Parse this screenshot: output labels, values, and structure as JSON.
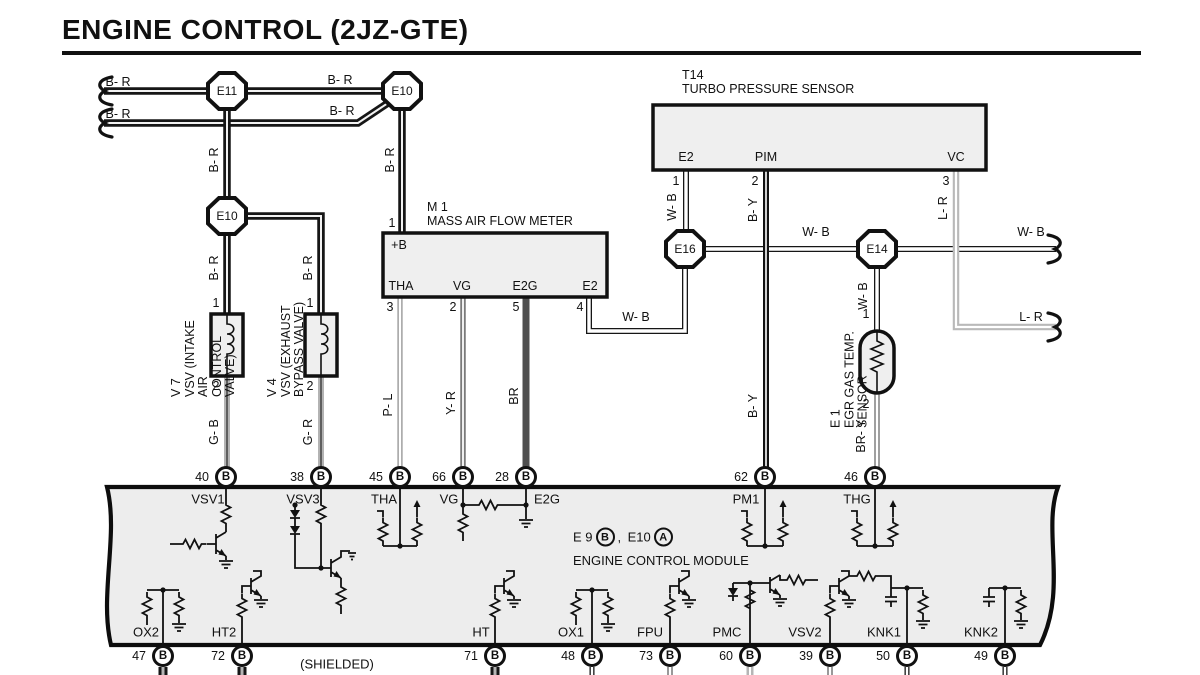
{
  "title": "ENGINE CONTROL (2JZ-GTE)",
  "colors": {
    "ecm_fill": "#ededed",
    "box_fill": "#efefef",
    "line": "#111111"
  },
  "connectors": [
    {
      "label": "E11",
      "x": 227,
      "y": 91
    },
    {
      "label": "E10",
      "x": 402,
      "y": 91
    },
    {
      "label": "E10",
      "x": 227,
      "y": 216
    },
    {
      "label": "E16",
      "x": 685,
      "y": 249
    },
    {
      "label": "E14",
      "x": 877,
      "y": 249
    }
  ],
  "boxes": {
    "turbo": {
      "ref": "T14",
      "name": "TURBO PRESSURE SENSOR",
      "terminals": [
        {
          "t": "E2",
          "x": 686,
          "y": 157
        },
        {
          "t": "PIM",
          "x": 766,
          "y": 157
        },
        {
          "t": "VC",
          "x": 956,
          "y": 157
        }
      ]
    },
    "maf": {
      "ref": "M 1",
      "name": "MASS AIR FLOW METER",
      "terminals": [
        {
          "t": "+B",
          "x": 399,
          "y": 245
        },
        {
          "t": "THA",
          "x": 401,
          "y": 286
        },
        {
          "t": "VG",
          "x": 462,
          "y": 286
        },
        {
          "t": "E2G",
          "x": 525,
          "y": 286
        },
        {
          "t": "E2",
          "x": 590,
          "y": 286
        }
      ]
    }
  },
  "components": [
    {
      "lines": [
        "V 7",
        "VSV (INTAKE AIR",
        "CONTROL VALVE)"
      ],
      "x": 190,
      "y": 347,
      "w": 100,
      "h": 40
    },
    {
      "lines": [
        "V 4",
        "VSV (EXHAUST",
        "BYPASS VALVE)"
      ],
      "x": 286,
      "y": 347,
      "w": 100,
      "h": 40
    },
    {
      "lines": [
        "E 1",
        "EGR GAS TEMP. SENSOR"
      ],
      "x": 843,
      "y": 363,
      "w": 130,
      "h": 27
    }
  ],
  "wire_labels": [
    {
      "t": "B- R",
      "x": 118,
      "y": 82
    },
    {
      "t": "B- R",
      "x": 118,
      "y": 114
    },
    {
      "t": "B- R",
      "x": 340,
      "y": 80
    },
    {
      "t": "B- R",
      "x": 342,
      "y": 111
    },
    {
      "t": "B- R",
      "x": 214,
      "y": 160,
      "r": 1
    },
    {
      "t": "B- R",
      "x": 390,
      "y": 160,
      "r": 1
    },
    {
      "t": "B- R",
      "x": 214,
      "y": 268,
      "r": 1
    },
    {
      "t": "B- R",
      "x": 308,
      "y": 268,
      "r": 1
    },
    {
      "t": "G- B",
      "x": 214,
      "y": 432,
      "r": 1
    },
    {
      "t": "G- R",
      "x": 308,
      "y": 432,
      "r": 1
    },
    {
      "t": "P- L",
      "x": 388,
      "y": 405,
      "r": 1
    },
    {
      "t": "Y- R",
      "x": 451,
      "y": 403,
      "r": 1
    },
    {
      "t": "BR",
      "x": 514,
      "y": 396,
      "r": 1
    },
    {
      "t": "W- B",
      "x": 636,
      "y": 317
    },
    {
      "t": "W- B",
      "x": 672,
      "y": 207,
      "r": 1
    },
    {
      "t": "B- Y",
      "x": 753,
      "y": 210,
      "r": 1
    },
    {
      "t": "B- Y",
      "x": 753,
      "y": 406,
      "r": 1
    },
    {
      "t": "L- R",
      "x": 943,
      "y": 208,
      "r": 1
    },
    {
      "t": "W- B",
      "x": 816,
      "y": 232
    },
    {
      "t": "W- B",
      "x": 1031,
      "y": 232
    },
    {
      "t": "L- R",
      "x": 1031,
      "y": 317
    },
    {
      "t": "W- B",
      "x": 863,
      "y": 296,
      "r": 1
    },
    {
      "t": "BR- Y",
      "x": 861,
      "y": 436,
      "r": 1
    }
  ],
  "pin_numbers": [
    {
      "t": "1",
      "x": 392,
      "y": 223
    },
    {
      "t": "3",
      "x": 390,
      "y": 307
    },
    {
      "t": "2",
      "x": 453,
      "y": 307
    },
    {
      "t": "5",
      "x": 516,
      "y": 307
    },
    {
      "t": "4",
      "x": 580,
      "y": 307
    },
    {
      "t": "1",
      "x": 676,
      "y": 181
    },
    {
      "t": "2",
      "x": 755,
      "y": 181
    },
    {
      "t": "3",
      "x": 946,
      "y": 181
    },
    {
      "t": "1",
      "x": 216,
      "y": 303
    },
    {
      "t": "2",
      "x": 216,
      "y": 386
    },
    {
      "t": "1",
      "x": 310,
      "y": 303
    },
    {
      "t": "2",
      "x": 310,
      "y": 386
    },
    {
      "t": "1",
      "x": 866,
      "y": 314
    },
    {
      "t": "2",
      "x": 866,
      "y": 404
    }
  ],
  "ecm": {
    "top_terminals": [
      {
        "pin": "40",
        "conn": "B",
        "name": "VSV1",
        "x": 226,
        "nx": 208
      },
      {
        "pin": "38",
        "conn": "B",
        "name": "VSV3",
        "x": 321,
        "nx": 303
      },
      {
        "pin": "45",
        "conn": "B",
        "name": "THA",
        "x": 400,
        "nx": 384
      },
      {
        "pin": "66",
        "conn": "B",
        "name": "VG",
        "x": 463,
        "nx": 449
      },
      {
        "pin": "28",
        "conn": "B",
        "name": "E2G",
        "x": 526,
        "nx": 547
      },
      {
        "pin": "62",
        "conn": "B",
        "name": "PM1",
        "x": 765,
        "nx": 746
      },
      {
        "pin": "46",
        "conn": "B",
        "name": "THG",
        "x": 875,
        "nx": 857
      }
    ],
    "bottom_terminals": [
      {
        "pin": "47",
        "conn": "B",
        "name": "OX2",
        "x": 163,
        "nx": 146
      },
      {
        "pin": "72",
        "conn": "B",
        "name": "HT2",
        "x": 242,
        "nx": 224
      },
      {
        "pin": "71",
        "conn": "B",
        "name": "HT",
        "x": 495,
        "nx": 481
      },
      {
        "pin": "48",
        "conn": "B",
        "name": "OX1",
        "x": 592,
        "nx": 571
      },
      {
        "pin": "73",
        "conn": "B",
        "name": "FPU",
        "x": 670,
        "nx": 650
      },
      {
        "pin": "60",
        "conn": "B",
        "name": "PMC",
        "x": 750,
        "nx": 727
      },
      {
        "pin": "39",
        "conn": "B",
        "name": "VSV2",
        "x": 830,
        "nx": 805
      },
      {
        "pin": "50",
        "conn": "B",
        "name": "KNK1",
        "x": 907,
        "nx": 884
      },
      {
        "pin": "49",
        "conn": "B",
        "name": "KNK2",
        "x": 1005,
        "nx": 981
      }
    ],
    "note": {
      "x": 573,
      "y": 537,
      "refs": [
        {
          "label": "E 9",
          "letter": "B"
        },
        {
          "label": "E10",
          "letter": "A"
        }
      ],
      "line2": "ENGINE CONTROL MODULE"
    },
    "shielded": "(SHIELDED)"
  }
}
